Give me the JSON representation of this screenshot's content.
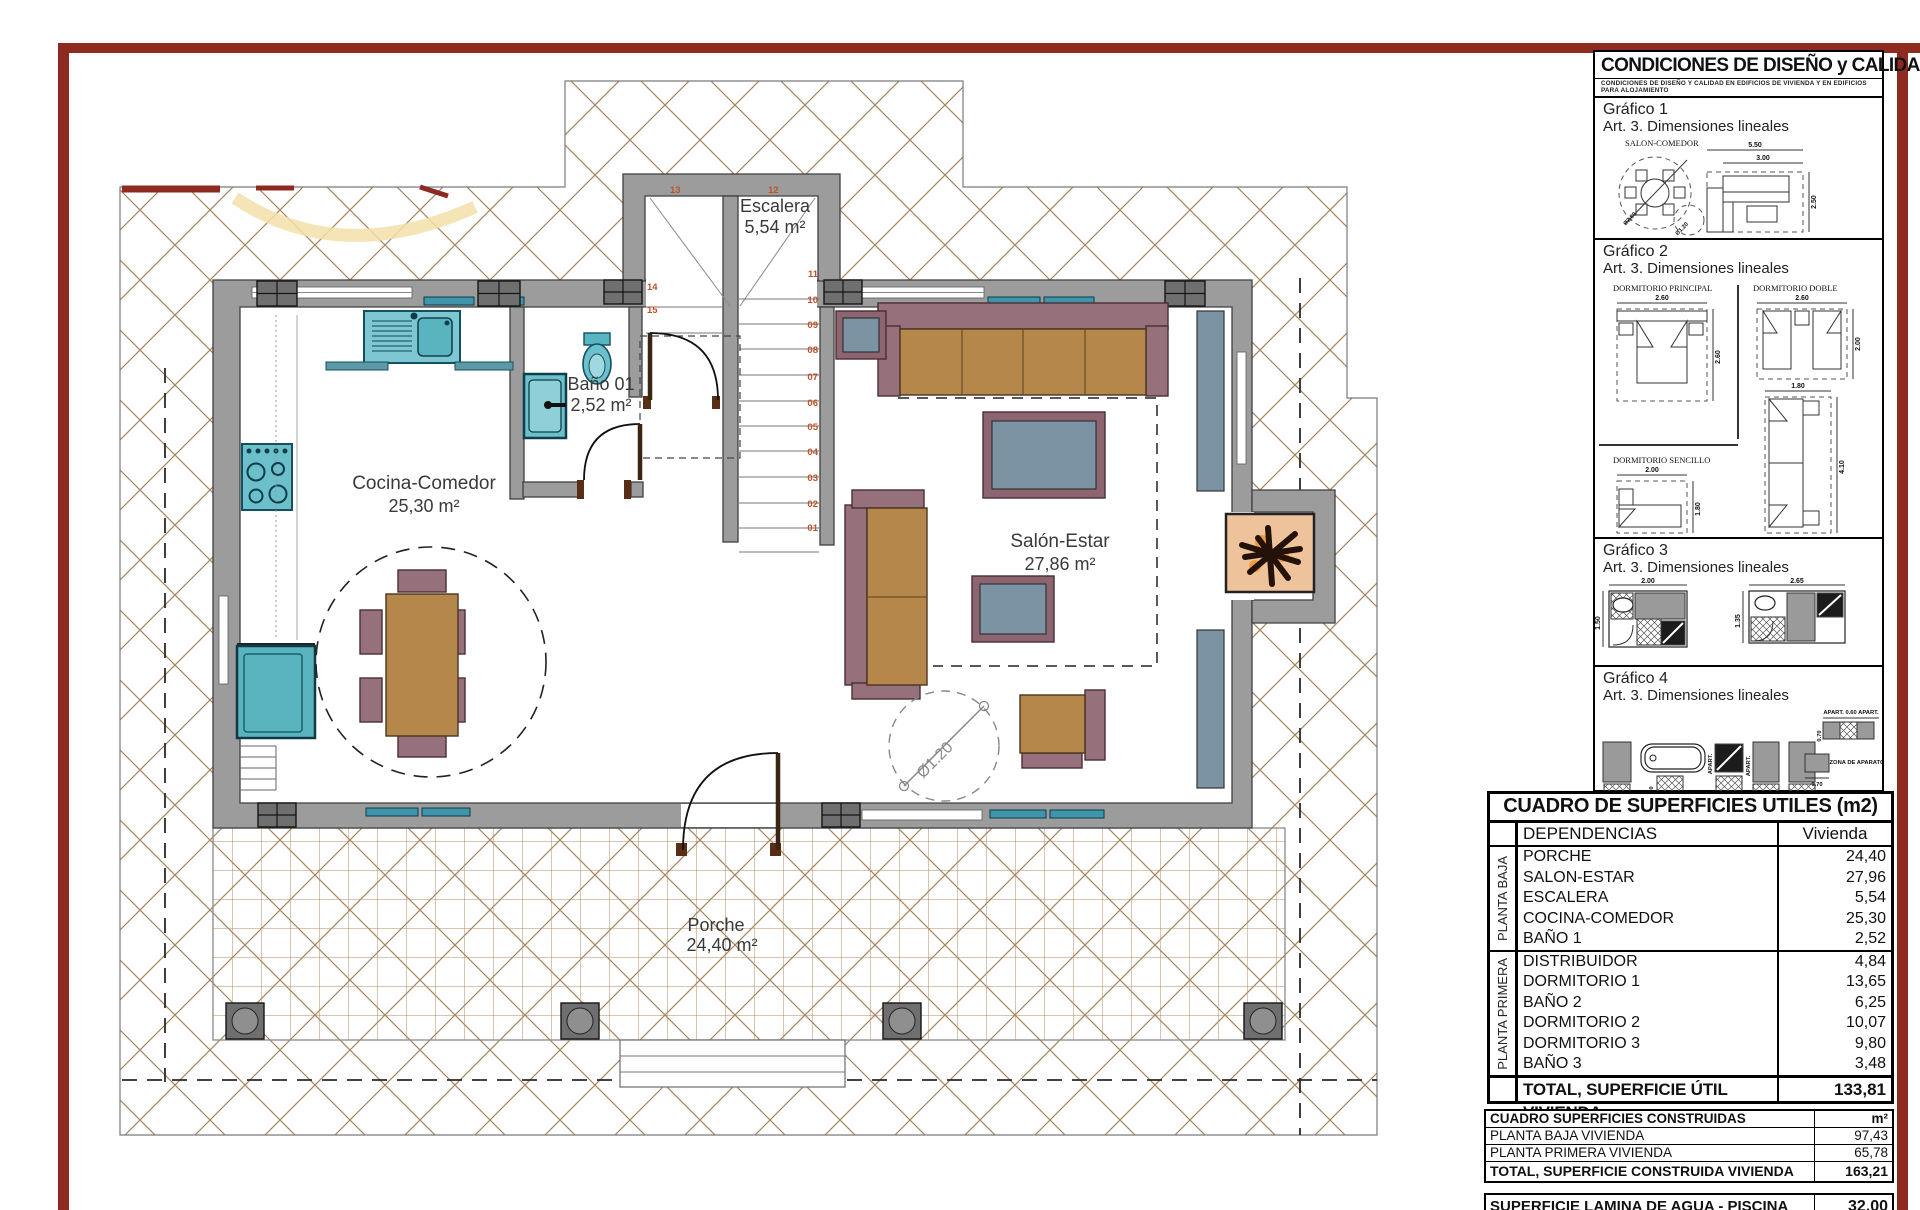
{
  "plan": {
    "rooms": {
      "escalera": {
        "name": "Escalera",
        "area": "5,54 m²"
      },
      "bano": {
        "name": "Baño 01",
        "area": "2,52 m²"
      },
      "cocina": {
        "name": "Cocina-Comedor",
        "area": "25,30 m²"
      },
      "salon": {
        "name": "Salón-Estar",
        "area": "27,86 m²"
      },
      "porche": {
        "name": "Porche",
        "area": "24,40 m²"
      }
    },
    "diameter_label": "Ø1.20",
    "stair_numbers": [
      "01",
      "02",
      "03",
      "04",
      "05",
      "06",
      "07",
      "08",
      "09",
      "10",
      "11",
      "12",
      "13",
      "14",
      "15"
    ]
  },
  "panel": {
    "title": "CONDICIONES DE DISEÑO y CALIDAD (DC-09)",
    "subtitle": "CONDICIONES DE DISEÑO Y CALIDAD EN EDIFICIOS DE VIVIENDA Y EN EDIFICIOS PARA ALOJAMIENTO",
    "g1": {
      "label": "Gráfico 1",
      "sub": "Art. 3. Dimensiones lineales",
      "caption": "SALON-COMEDOR",
      "dim_w": "5.50",
      "dim_iw": "3.00",
      "dim_h": "2.50",
      "dim_d1": "Ø2.80",
      "dim_d2": "Ø1.20"
    },
    "g2": {
      "label": "Gráfico 2",
      "sub": "Art. 3. Dimensiones lineales",
      "principal": {
        "caption": "DORMITORIO PRINCIPAL",
        "w": "2.60",
        "h": "2.60"
      },
      "doble": {
        "caption": "DORMITORIO DOBLE",
        "w": "2.60",
        "h": "2.00"
      },
      "doble2": {
        "w": "1.80",
        "h": "4.10"
      },
      "sencillo": {
        "caption": "DORMITORIO SENCILLO",
        "w": "2.00",
        "h": "1.80"
      }
    },
    "g3": {
      "label": "Gráfico 3",
      "sub": "Art. 3. Dimensiones lineales",
      "b1w": "2.00",
      "b1h": "1.50",
      "b2w": "2.65",
      "b2h": "1.35"
    },
    "g4": {
      "label": "Gráfico 4",
      "sub": "Art. 3. Dimensiones lineales",
      "d070": "0.70",
      "d060": "0.60",
      "apart": "APART.",
      "apart_row": "APART. 0.60 APART.",
      "zona_aparato": "ZONA DE APARATO",
      "zona_uso": "ZONA DE USO"
    }
  },
  "tables": {
    "useful": {
      "title": "CUADRO DE SUPERFICIES UTILES (m2)",
      "col1": "DEPENDENCIAS",
      "col2": "Vivienda",
      "group1": "PLANTA BAJA",
      "group2": "PLANTA PRIMERA",
      "rows_baja": [
        [
          "PORCHE",
          "24,40"
        ],
        [
          "SALON-ESTAR",
          "27,96"
        ],
        [
          "ESCALERA",
          "5,54"
        ],
        [
          "COCINA-COMEDOR",
          "25,30"
        ],
        [
          "BAÑO 1",
          "2,52"
        ]
      ],
      "rows_primera": [
        [
          "DISTRIBUIDOR",
          "4,84"
        ],
        [
          "DORMITORIO 1",
          "13,65"
        ],
        [
          "BAÑO 2",
          "6,25"
        ],
        [
          "DORMITORIO 2",
          "10,07"
        ],
        [
          "DORMITORIO 3",
          "9,80"
        ],
        [
          "BAÑO 3",
          "3,48"
        ]
      ],
      "total_label": "TOTAL, SUPERFICIE ÚTIL VIVIENDA",
      "total_value": "133,81"
    },
    "built": {
      "title": "CUADRO SUPERFICIES CONSTRUIDAS",
      "unit": "m²",
      "rows": [
        [
          "PLANTA BAJA VIVIENDA",
          "97,43"
        ],
        [
          "PLANTA PRIMERA VIVIENDA",
          "65,78"
        ]
      ],
      "total_label": "TOTAL, SUPERFICIE CONSTRUIDA VIVIENDA",
      "total_value": "163,21",
      "pool_label": "SUPERFICIE LAMINA DE AGUA - PISCINA",
      "pool_value": "32,00"
    }
  }
}
